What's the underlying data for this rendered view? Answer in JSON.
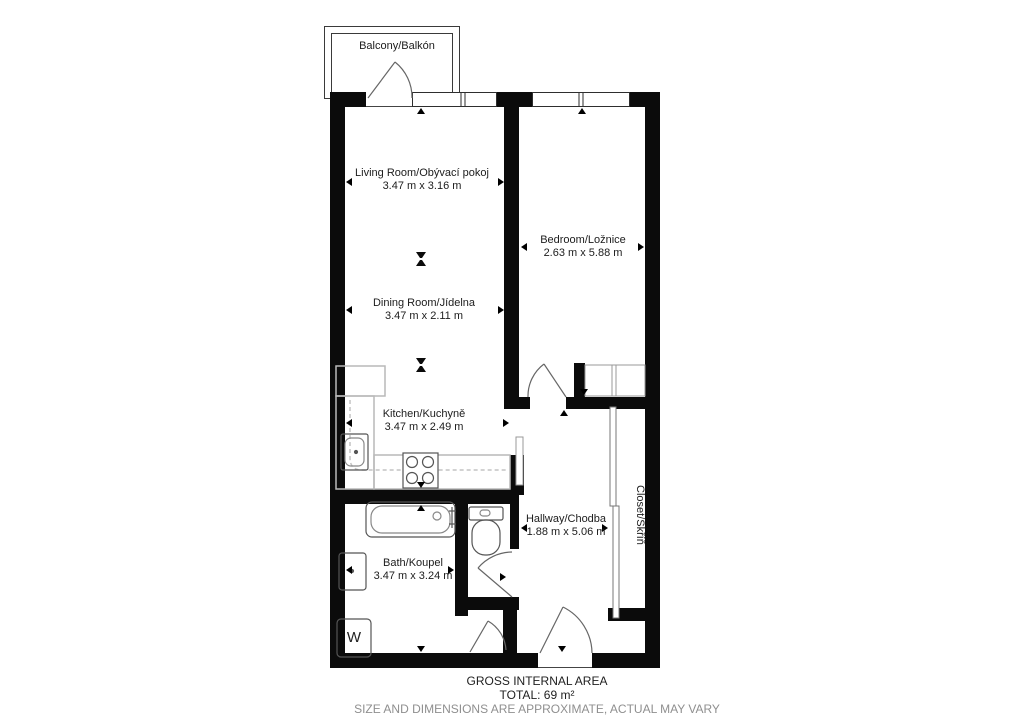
{
  "floorplan": {
    "balcony": {
      "label": "Balcony/Balkón"
    },
    "rooms": [
      {
        "name": "Living Room/Obývací pokoj",
        "dims": "3.47 m x 3.16 m"
      },
      {
        "name": "Dining Room/Jídelna",
        "dims": "3.47 m x 2.11 m"
      },
      {
        "name": "Kitchen/Kuchyně",
        "dims": "3.47 m x 2.49 m"
      },
      {
        "name": "Bedroom/Ložnice",
        "dims": "2.63 m x 5.88 m"
      },
      {
        "name": "Hallway/Chodba",
        "dims": "1.88 m x 5.06 m"
      },
      {
        "name": "Bath/Koupel",
        "dims": "3.47 m x 3.24 m"
      },
      {
        "name": "Closet/Skříň"
      }
    ],
    "appliances": {
      "washer_label": "W"
    },
    "footer": {
      "line1": "GROSS INTERNAL AREA",
      "line2": "TOTAL: 69 m²",
      "line3": "SIZE AND DIMENSIONS ARE APPROXIMATE, ACTUAL MAY VARY"
    },
    "colors": {
      "wall": "#0b0b0b",
      "fixture": "#555555",
      "counter": "#b9b9b9",
      "footer_gray": "#8f8f8f"
    }
  }
}
